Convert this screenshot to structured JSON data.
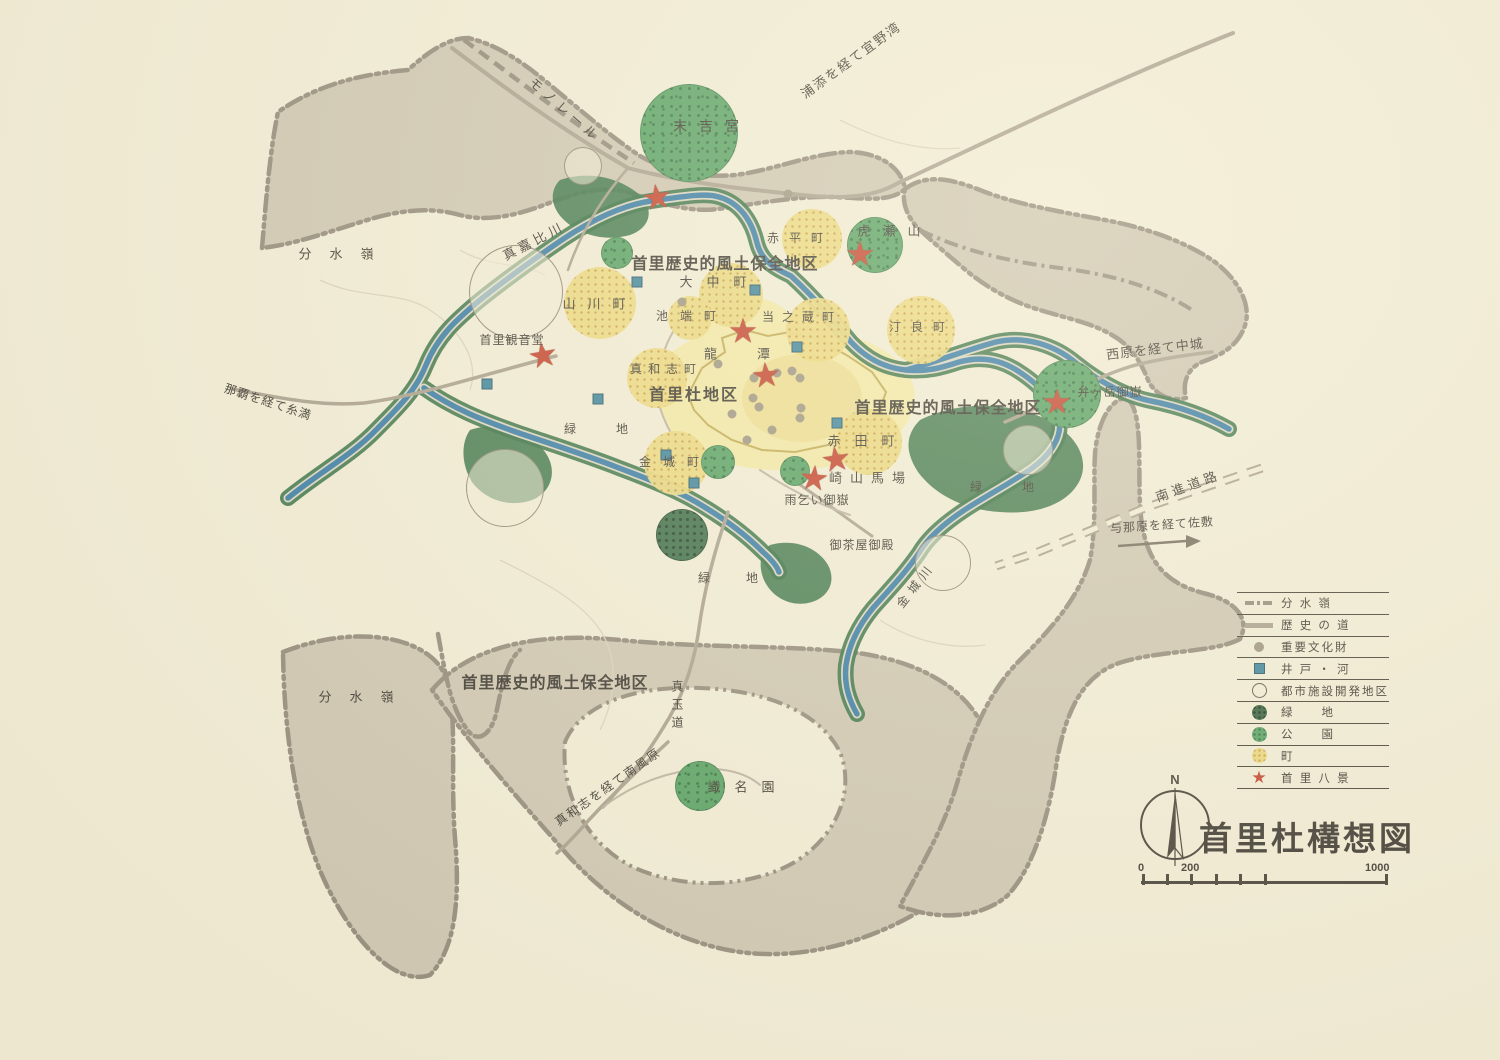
{
  "map_title": "首里杜構想図",
  "compass": {
    "label": "N"
  },
  "scale_bar": {
    "labels": [
      "0",
      "200",
      "1000"
    ],
    "tick_offsets": [
      1,
      25,
      49,
      74,
      98,
      123,
      244
    ],
    "num_offsets": [
      -3,
      40,
      224
    ]
  },
  "colors": {
    "paper": "#f2edd8",
    "gray": "#cdc5b2",
    "grayEdge": "#8f8679",
    "road": "#a69c8c",
    "roadThin": "#b9b0a0",
    "rail": "#8d8476",
    "river": "#3077a6",
    "riverEdge": "#d9d5c1",
    "veg": "#2e6b40",
    "park": "#4f9e5f",
    "parkDot": "#2f7040",
    "town": "#ecd87c",
    "townDot": "#c49a3a",
    "castle": "#f3e9a7",
    "castleCore": "#eedd8f",
    "star": "#c23b27",
    "well": "#35809c",
    "dot": "#99917f",
    "ink": "#332f2a",
    "wall": "#c0a84e"
  },
  "legend": {
    "items": [
      {
        "symbol": "watershed",
        "label": "分 水 嶺"
      },
      {
        "symbol": "historic-road",
        "label": "歴 史 の 道"
      },
      {
        "symbol": "cultural-property",
        "label": "重要文化財"
      },
      {
        "symbol": "well-river",
        "label": "井 戸 ・ 河"
      },
      {
        "symbol": "urban-development",
        "label": "都市施設開発地区"
      },
      {
        "symbol": "green-space",
        "label": "緑　　地"
      },
      {
        "symbol": "park",
        "label": "公　　園"
      },
      {
        "symbol": "town",
        "label": "町"
      },
      {
        "symbol": "shuri-eight-views",
        "label": "首 里 八 景"
      }
    ]
  },
  "labels": [
    {
      "t": "モノレール",
      "x": 565,
      "y": 110,
      "fs": 13,
      "rot": 41,
      "ls": 5
    },
    {
      "t": "浦添を経て宜野湾",
      "x": 851,
      "y": 60,
      "fs": 13,
      "rot": -36,
      "ls": 2
    },
    {
      "t": "末吉宮",
      "x": 712,
      "y": 126,
      "fs": 14,
      "ls": 12
    },
    {
      "t": "分水嶺",
      "x": 345,
      "y": 254,
      "fs": 13,
      "ls": 18
    },
    {
      "t": "真嘉比川",
      "x": 534,
      "y": 241,
      "fs": 13,
      "rot": -27,
      "ls": 4
    },
    {
      "t": "山川町",
      "x": 600,
      "y": 304,
      "fs": 13,
      "ls": 12
    },
    {
      "t": "首里歴史的風土保全地区",
      "x": 725,
      "y": 265,
      "fs": 16,
      "ls": 1,
      "bold": true
    },
    {
      "t": "大中町",
      "x": 720,
      "y": 282,
      "fs": 13,
      "ls": 14
    },
    {
      "t": "池端町",
      "x": 692,
      "y": 316,
      "fs": 12,
      "ls": 12
    },
    {
      "t": "当之蔵町",
      "x": 802,
      "y": 317,
      "fs": 12,
      "ls": 8
    },
    {
      "t": "汀良町",
      "x": 922,
      "y": 327,
      "fs": 12,
      "ls": 10
    },
    {
      "t": "虎瀬山",
      "x": 895,
      "y": 231,
      "fs": 13,
      "ls": 12
    },
    {
      "t": "龍潭",
      "x": 757,
      "y": 354,
      "fs": 13,
      "ls": 40
    },
    {
      "t": "真和志町",
      "x": 666,
      "y": 369,
      "fs": 12,
      "ls": 6
    },
    {
      "t": "首里杜地区",
      "x": 694,
      "y": 396,
      "fs": 16,
      "ls": 2,
      "bold": true
    },
    {
      "t": "首里観音堂",
      "x": 512,
      "y": 340,
      "fs": 12,
      "ls": 1
    },
    {
      "t": "赤平町",
      "x": 800,
      "y": 238,
      "fs": 12,
      "ls": 10
    },
    {
      "t": "西原を経て中城",
      "x": 1155,
      "y": 349,
      "fs": 13,
      "rot": -7,
      "ls": 1
    },
    {
      "t": "弁ヶ岳御嶽",
      "x": 1110,
      "y": 392,
      "fs": 12,
      "ls": 1
    },
    {
      "t": "南進道路",
      "x": 1188,
      "y": 486,
      "fs": 13,
      "rot": -20,
      "ls": 4
    },
    {
      "t": "与那原を経て佐敷",
      "x": 1162,
      "y": 525,
      "fs": 12,
      "rot": -4,
      "ls": 1
    },
    {
      "t": "緑地",
      "x": 616,
      "y": 429,
      "fs": 12,
      "ls": 40
    },
    {
      "t": "金城町",
      "x": 675,
      "y": 462,
      "fs": 12,
      "ls": 12
    },
    {
      "t": "赤田町",
      "x": 868,
      "y": 441,
      "fs": 13,
      "ls": 14
    },
    {
      "t": "崎山馬場",
      "x": 871,
      "y": 478,
      "fs": 13,
      "ls": 8
    },
    {
      "t": "雨乞い御嶽",
      "x": 817,
      "y": 500,
      "fs": 12,
      "ls": 1
    },
    {
      "t": "首里歴史的風土保全地区",
      "x": 948,
      "y": 409,
      "fs": 16,
      "ls": 1,
      "bold": true
    },
    {
      "t": "御茶屋御殿",
      "x": 862,
      "y": 545,
      "fs": 12,
      "ls": 1
    },
    {
      "t": "金城川",
      "x": 916,
      "y": 585,
      "fs": 12,
      "rot": -52,
      "ls": 6
    },
    {
      "t": "緑地",
      "x": 1022,
      "y": 487,
      "fs": 12,
      "ls": 40
    },
    {
      "t": "緑地",
      "x": 746,
      "y": 578,
      "fs": 12,
      "ls": 36
    },
    {
      "t": "分水嶺",
      "x": 365,
      "y": 697,
      "fs": 13,
      "ls": 18
    },
    {
      "t": "首里歴史的風土保全地区",
      "x": 555,
      "y": 684,
      "fs": 16,
      "ls": 1,
      "bold": true
    },
    {
      "t": "真和志を経て南風原",
      "x": 608,
      "y": 787,
      "fs": 12,
      "rot": -35,
      "ls": 2
    },
    {
      "t": "真玉道",
      "x": 677,
      "y": 707,
      "fs": 12,
      "vert": true
    },
    {
      "t": "識名園",
      "x": 748,
      "y": 787,
      "fs": 13,
      "ls": 14
    },
    {
      "t": "那覇を経て糸満",
      "x": 268,
      "y": 402,
      "fs": 12,
      "rot": 18,
      "ls": 1
    }
  ],
  "features": {
    "town_circles": [
      {
        "name": "yamakawa-town",
        "x": 600,
        "y": 303,
        "r": 36
      },
      {
        "name": "akahira-town",
        "x": 812,
        "y": 239,
        "r": 30
      },
      {
        "name": "onaka-town",
        "x": 731,
        "y": 295,
        "r": 32
      },
      {
        "name": "ikehata-town",
        "x": 690,
        "y": 318,
        "r": 22
      },
      {
        "name": "tonokura-town",
        "x": 818,
        "y": 330,
        "r": 32
      },
      {
        "name": "tera-town",
        "x": 921,
        "y": 330,
        "r": 34
      },
      {
        "name": "mawashi-town",
        "x": 657,
        "y": 378,
        "r": 30
      },
      {
        "name": "kinjo-town",
        "x": 676,
        "y": 463,
        "r": 32
      },
      {
        "name": "akata-town",
        "x": 869,
        "y": 442,
        "r": 33
      }
    ],
    "park_circles": [
      {
        "name": "sueyoshi-park",
        "x": 689,
        "y": 133,
        "r": 49
      },
      {
        "name": "park-small-nw",
        "x": 617,
        "y": 253,
        "r": 16
      },
      {
        "name": "torase-park",
        "x": 875,
        "y": 245,
        "r": 28
      },
      {
        "name": "bengadake-park",
        "x": 1067,
        "y": 394,
        "r": 34
      },
      {
        "name": "park-small-1",
        "x": 718,
        "y": 462,
        "r": 17
      },
      {
        "name": "park-small-2",
        "x": 795,
        "y": 471,
        "r": 15
      },
      {
        "name": "shikinaen-park",
        "x": 700,
        "y": 786,
        "r": 25
      }
    ],
    "greenspace_circles": [
      {
        "name": "greenspace-circle",
        "x": 682,
        "y": 535,
        "r": 26
      }
    ],
    "white_circles": [
      {
        "name": "development-district",
        "x": 516,
        "y": 292,
        "r": 46
      },
      {
        "name": "development-district",
        "x": 583,
        "y": 166,
        "r": 18
      },
      {
        "name": "development-district",
        "x": 505,
        "y": 488,
        "r": 38
      },
      {
        "name": "development-district",
        "x": 943,
        "y": 563,
        "r": 27
      },
      {
        "name": "development-district",
        "x": 1028,
        "y": 450,
        "r": 24
      }
    ],
    "wells": [
      [
        487,
        384
      ],
      [
        598,
        399
      ],
      [
        637,
        282
      ],
      [
        755,
        290
      ],
      [
        666,
        455
      ],
      [
        694,
        483
      ],
      [
        797,
        347
      ],
      [
        837,
        423
      ]
    ],
    "cultural_dots": [
      [
        682,
        302
      ],
      [
        788,
        194
      ],
      [
        718,
        364
      ],
      [
        754,
        378
      ],
      [
        777,
        373
      ],
      [
        792,
        371
      ],
      [
        800,
        378
      ],
      [
        753,
        398
      ],
      [
        759,
        407
      ],
      [
        732,
        414
      ],
      [
        801,
        408
      ],
      [
        800,
        418
      ],
      [
        772,
        430
      ],
      [
        747,
        440
      ]
    ],
    "stars": [
      {
        "name": "star-sueyoshi",
        "x": 657,
        "y": 199,
        "rot": -8
      },
      {
        "name": "star-torase",
        "x": 860,
        "y": 256,
        "rot": 0
      },
      {
        "name": "star-kannondo",
        "x": 543,
        "y": 357,
        "rot": -10
      },
      {
        "name": "star-ryutan",
        "x": 743,
        "y": 333,
        "rot": 0
      },
      {
        "name": "star-shurijo",
        "x": 766,
        "y": 377,
        "rot": -5
      },
      {
        "name": "star-bengadake",
        "x": 1057,
        "y": 404,
        "rot": 0
      },
      {
        "name": "star-sakiyama",
        "x": 836,
        "y": 461,
        "rot": -8
      },
      {
        "name": "star-amagoi",
        "x": 814,
        "y": 480,
        "rot": 5
      }
    ]
  }
}
